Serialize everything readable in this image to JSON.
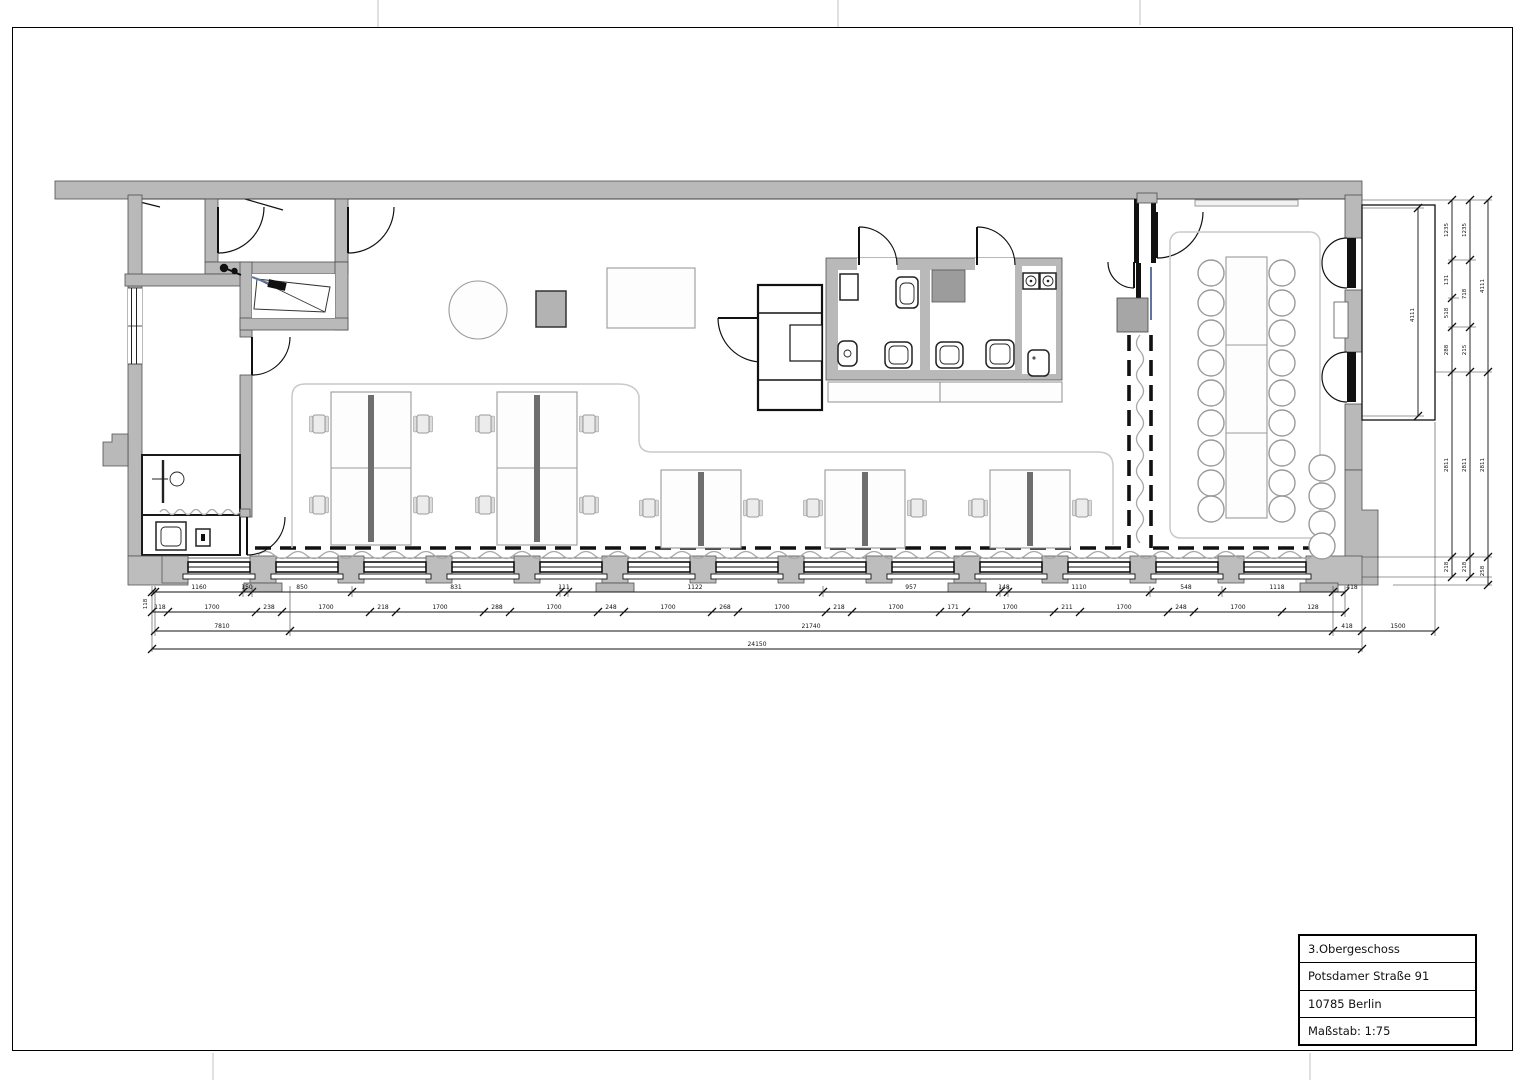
{
  "title_block": {
    "floor": "3.Obergeschoss",
    "street": "Potsdamer Straße 91",
    "city": "10785 Berlin",
    "scale": "Maßstab: 1:75"
  },
  "dims": {
    "bottom_row1": [
      "1160",
      "150",
      "850",
      "831",
      "111",
      "1122",
      "957",
      "148",
      "1110",
      "548",
      "1118",
      "418"
    ],
    "bottom_row2": [
      "118",
      "1700",
      "238",
      "1700",
      "218",
      "1700",
      "288",
      "1700",
      "248",
      "1700",
      "268",
      "1700",
      "218",
      "1700",
      "171",
      "1700",
      "211",
      "1700",
      "248",
      "1700",
      "128"
    ],
    "bottom_row3": [
      "7810",
      "21740",
      "418",
      "1500"
    ],
    "bottom_row4": [
      "24150"
    ],
    "left_vertical": "118",
    "balcony_height": "4111",
    "right_chain_a": [
      "1235",
      "131",
      "518",
      "288",
      "2811",
      "218"
    ],
    "right_chain_b": [
      "1235",
      "718",
      "215",
      "2811",
      "218"
    ],
    "right_chain_c": [
      "4111",
      "2811",
      "258"
    ]
  }
}
